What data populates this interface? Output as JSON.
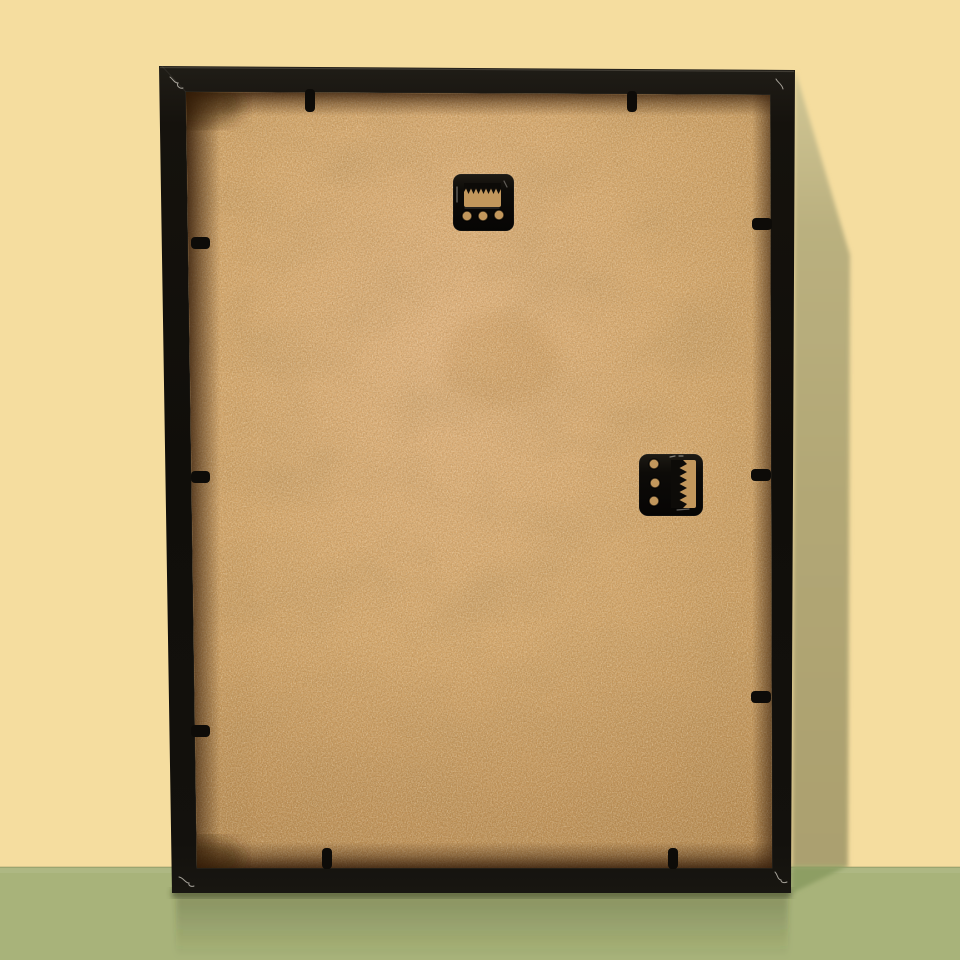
{
  "description": "Back view of a black box picture frame leaning against a pale yellow wall on a sage green floor: tan MDF backing board, one horizontal sawtooth hanger near the top, one vertical sawtooth hanger at the middle right, and ten black retaining tabs around the inner edge; soft shadow cast on the wall and floor to the right",
  "colors": {
    "wall": "#f5dd9f",
    "wallShadow": "#b2a675",
    "wallShadowLight": "#d0c593",
    "floor": "#a8b37a",
    "floorLight": "#b2bd85",
    "floorShadow": "#8d9e64",
    "frameBlack": "#100e0a",
    "frameSheen": "#201d17",
    "frameEdge": "#46423a",
    "backing": "#d2a468",
    "backingLight": "#deb07b",
    "backingDark": "#bb8e51",
    "recess": "#371f0c",
    "hardware": "#0d0b08",
    "hardwareGlint": "#eee9df",
    "holeTan": "#c2975c",
    "reflection": "#3a4224"
  },
  "objects": {
    "wall": "pale-yellow-wall",
    "floor": "green-floor",
    "frame": "black-box-frame-back",
    "backing": "mdf-backing-board",
    "hanger_top": "sawtooth-hanger-horizontal",
    "hanger_side": "sawtooth-hanger-vertical",
    "tabs": "retaining-flexi-tabs",
    "tab_count": 10,
    "hanger_count": 2
  }
}
